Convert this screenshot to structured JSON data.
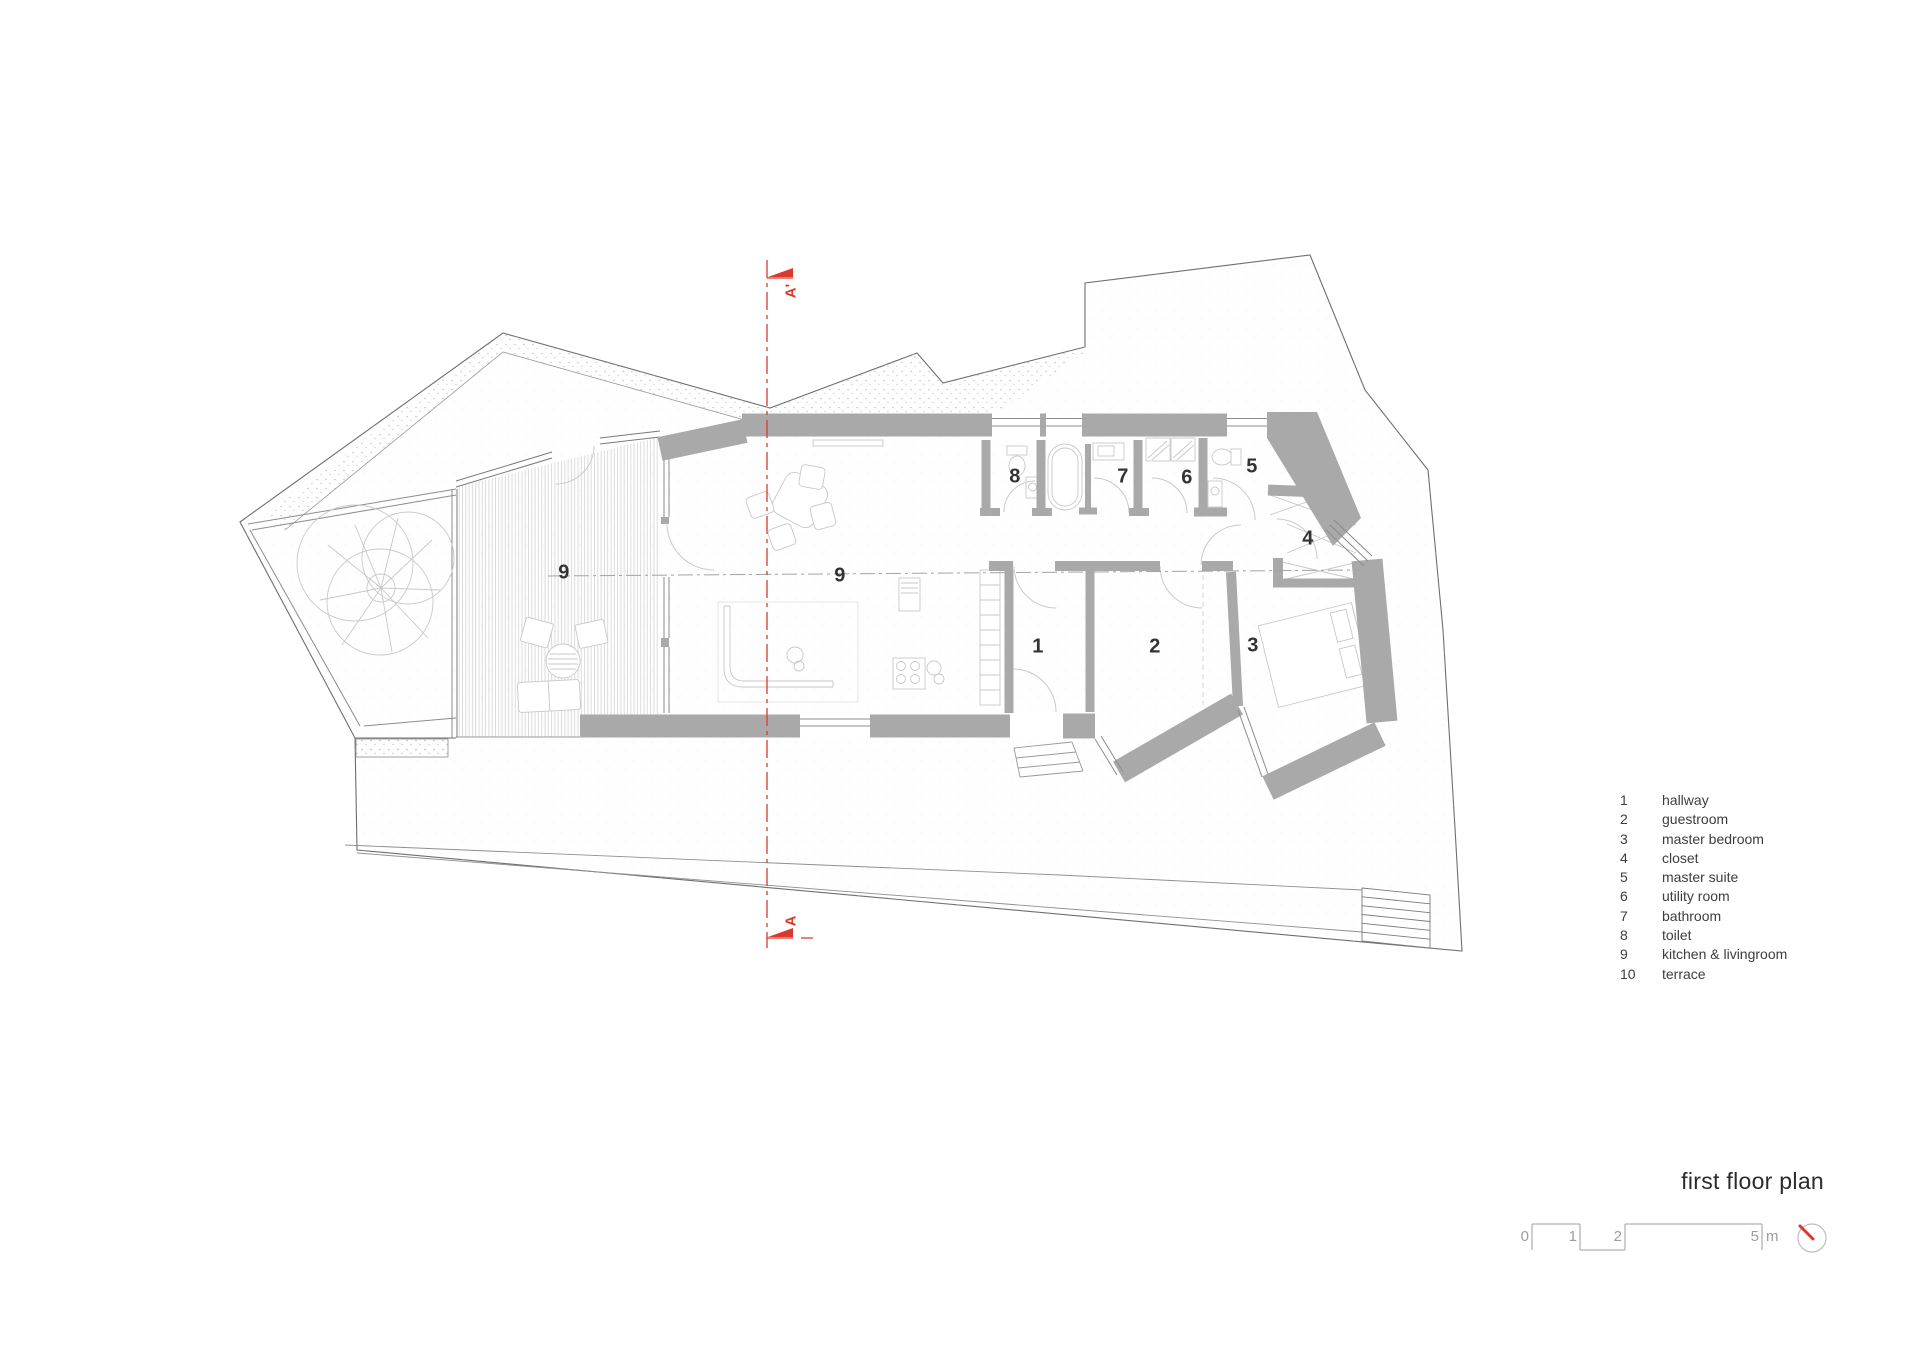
{
  "title": {
    "text": "first floor plan"
  },
  "section_markers": {
    "top": "A'",
    "bottom": "A"
  },
  "rooms": [
    {
      "num": "9",
      "area": "terrace deck"
    },
    {
      "num": "9",
      "area": "kitchen & livingroom"
    },
    {
      "num": "8",
      "area": "toilet"
    },
    {
      "num": "7",
      "area": "bathroom"
    },
    {
      "num": "6",
      "area": "utility room"
    },
    {
      "num": "5",
      "area": "master suite"
    },
    {
      "num": "4",
      "area": "closet"
    },
    {
      "num": "1",
      "area": "hallway"
    },
    {
      "num": "2",
      "area": "guestroom"
    },
    {
      "num": "3",
      "area": "master bedroom"
    }
  ],
  "legend": {
    "items": [
      {
        "num": "1",
        "label": "hallway"
      },
      {
        "num": "2",
        "label": "guestroom"
      },
      {
        "num": "3",
        "label": "master bedroom"
      },
      {
        "num": "4",
        "label": "closet"
      },
      {
        "num": "5",
        "label": "master suite"
      },
      {
        "num": "6",
        "label": "utility room"
      },
      {
        "num": "7",
        "label": "bathroom"
      },
      {
        "num": "8",
        "label": "toilet"
      },
      {
        "num": "9",
        "label": "kitchen & livingroom"
      },
      {
        "num": "10",
        "label": "terrace"
      }
    ]
  },
  "scale_bar": {
    "tick_labels": [
      "0",
      "1",
      "2",
      "5"
    ],
    "unit": "m"
  },
  "colors": {
    "section_red": "#da392e",
    "wall_gray": "#a9a9a9",
    "boundary_line": "#6f6f6f",
    "furniture_gray": "#c8c8c8",
    "text_dark": "#333333",
    "text_gray": "#9c9c9c"
  }
}
